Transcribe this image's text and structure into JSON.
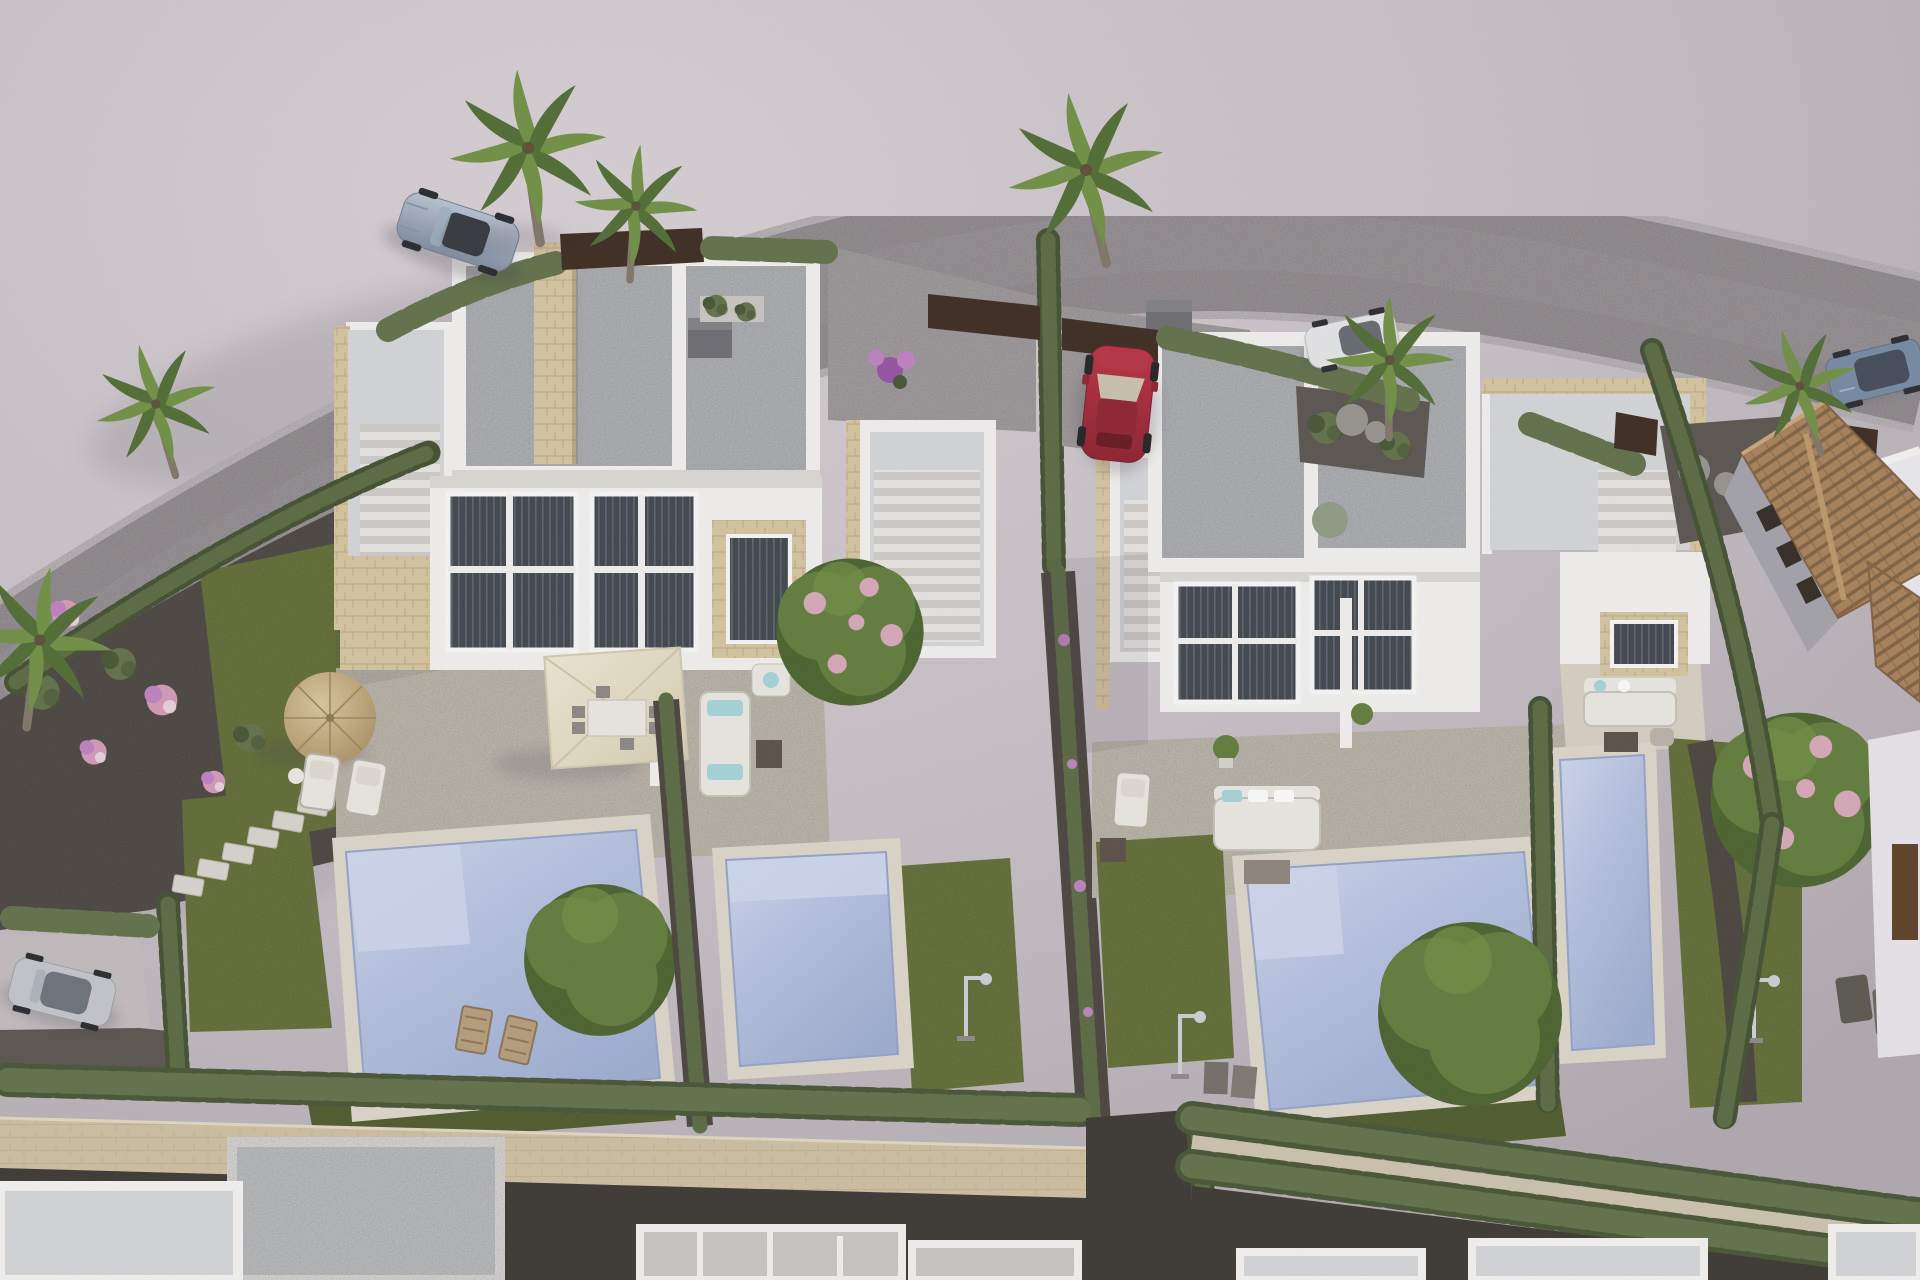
{
  "scene": {
    "type": "architectural-3d-render",
    "view": "aerial-oblique",
    "subject": "New-build development of two modern white duplex villas with private pools and landscaped gardens",
    "setting": "Curved suburban road above the plots, existing terracotta-roof house to the right, row of villas under construction along the bottom edge",
    "lighting": "Warm low sun from the upper right, long soft shadows on pale mauve-grey ground",
    "visible_text": []
  },
  "palette": {
    "groundLight": "#d8d2d6",
    "ground": "#c7c0c6",
    "groundDark": "#b0a9af",
    "road": "#a7a1a4",
    "roadEdge": "#d4ced1",
    "gravel": "#56514b",
    "gravelDark": "#454039",
    "alley": "#37342f",
    "wall": "#f4f3f1",
    "wallShade": "#dcdad6",
    "roof": "#c7c9cc",
    "roofLight": "#d5d7d9",
    "stone": "#d6c69f",
    "stoneJoint": "#b39f77",
    "stoneWall": "#cfc0a0",
    "terrace": "#d7d1c3",
    "deck": "#ded8ca",
    "lawn": "#71803c",
    "lawnDark": "#5c6a30",
    "hedge": "#5e6e45",
    "hedgeDark": "#43512f",
    "cypress": "#57683d",
    "cypDark": "#3e4c2c",
    "water": "#b4c2e1",
    "waterLight": "#cfd8ee",
    "waterDeep": "#9dadd2",
    "parasol": "#e7e1cb",
    "straw": "#c9b285",
    "strawDark": "#9b865b",
    "teal": "#a5d6d9",
    "furn": "#eceae3",
    "furnLine": "#c6c2b8",
    "woodDark": "#564d42",
    "gate": "#38261a",
    "terracotta": "#a87f56",
    "terracottaDark": "#7f5f3e",
    "ridge": "#c19a6b",
    "carRed": "#a32332",
    "carSilver": "#98a5b7",
    "carWhite": "#e6e7e9",
    "carSuv": "#7487a2",
    "carGray": "#c3c6ca",
    "glass": "#3c4148",
    "glassLight": "#59606a",
    "trunk": "#7d7464",
    "palmA": "#6d8f3f",
    "palmB": "#4c6a2e",
    "tree": "#5e7a36",
    "treeDark": "#466028",
    "blossom": "#d8a8b8",
    "purple": "#9550a0",
    "purpleLight": "#c07fc0",
    "pink": "#d49ab5",
    "boulder": "#95928c",
    "chrome": "#cdd1d6",
    "shadow": "#3c3545"
  },
  "objects": {
    "buildings": [
      {
        "name": "left-duplex-villa",
        "units": 2,
        "features": [
          "flat grey gravel roof",
          "white parapets",
          "beige stone accent walls",
          "rear roof-terrace with external staircase",
          "two-storey glazed facade",
          "cream paved terrace"
        ]
      },
      {
        "name": "right-duplex-villa",
        "units": 2,
        "features": [
          "flat grey gravel roof",
          "white parapets",
          "stone-trimmed roof solarium with staircase",
          "two-storey glazed facade",
          "cream paved terrace"
        ]
      },
      {
        "name": "existing-house",
        "roof": "terracotta tiles, two gables",
        "walls": "grey with tall dark windows"
      },
      {
        "name": "villas-under-construction",
        "count": 6,
        "position": "bottom edge, white parapet walls"
      }
    ],
    "pools": [
      {
        "owner": "left-villa-unit-a",
        "size": "large rectangular"
      },
      {
        "owner": "left-villa-unit-b",
        "size": "small rectangular with entry steps"
      },
      {
        "owner": "right-villa-unit-a",
        "size": "large rectangular with corner steps"
      },
      {
        "owner": "right-villa-unit-b",
        "size": "narrow plunge pool"
      }
    ],
    "vehicles": [
      {
        "name": "convertible-sports-car",
        "color": "silver-blue",
        "location": "road, upper left"
      },
      {
        "name": "hatchback",
        "color": "red",
        "location": "right villa driveway"
      },
      {
        "name": "city-car",
        "color": "white",
        "location": "road, right of centre"
      },
      {
        "name": "suv",
        "color": "blue-grey",
        "location": "road, upper right corner"
      },
      {
        "name": "hatchback",
        "color": "silver",
        "location": "parking bay, lower left"
      }
    ],
    "vegetation": {
      "palm_trees": 7,
      "cypress_hedges": "along road, plot dividers and rear boundary",
      "bougainvillea": "purple flowering divider and specimen tree",
      "ornamental_trees": 3,
      "flower_shrubs": "pink, purple and white on grey gravel beds",
      "lawns": 8
    },
    "amenities": {
      "round_straw_umbrella": 1,
      "square_cream_parasol": 1,
      "sun_loungers": 6,
      "outdoor_sofa_sets": 3,
      "dining_set": 1,
      "outdoor_showers": 3,
      "stepping_stone_path": 1,
      "boulder_features": 2
    },
    "boundaries": {
      "stone_wall": "sandstone block wall along rear boundary",
      "gates": "dark corten-brown privacy panels at driveways",
      "alley": "dark gravel service lane below the wall"
    }
  }
}
